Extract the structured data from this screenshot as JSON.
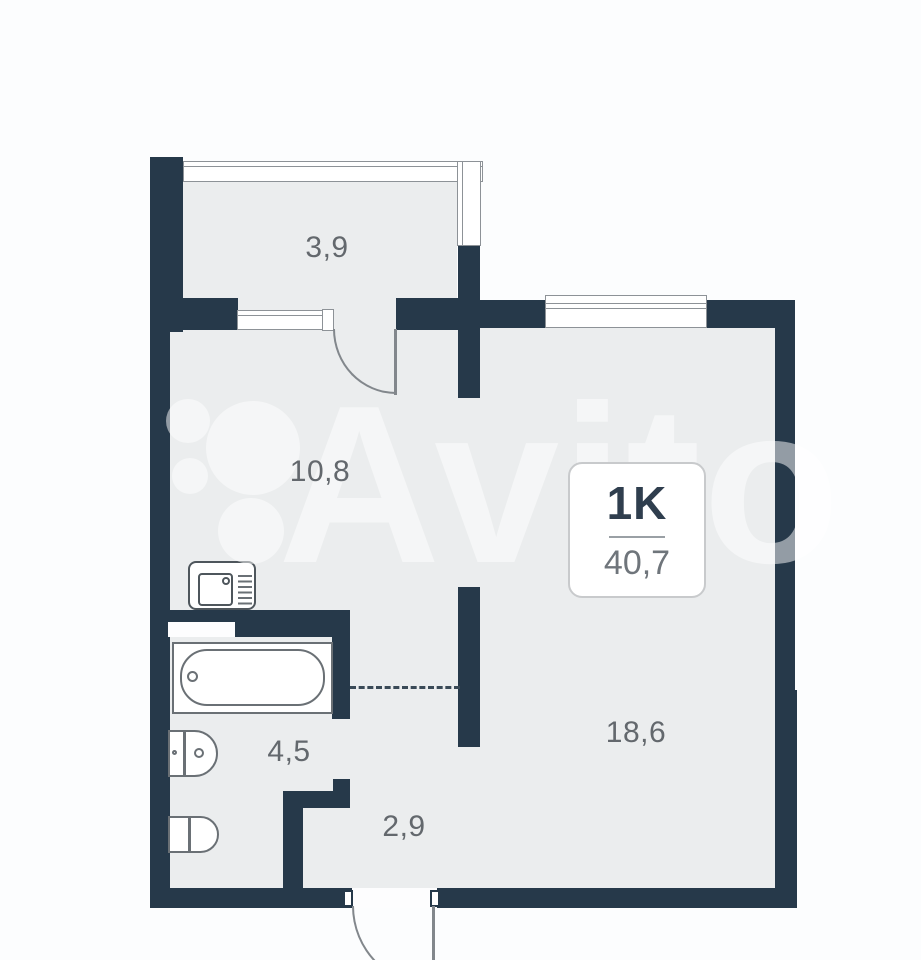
{
  "page": {
    "type": "apartment-floor-plan"
  },
  "watermark": {
    "brand": "Avito"
  },
  "plan": {
    "info_card": {
      "unit_type": "1K",
      "total_area": "40,7"
    },
    "rooms": [
      {
        "name": "balcony",
        "area_label": "3,9"
      },
      {
        "name": "kitchen-living",
        "area_label": "10,8"
      },
      {
        "name": "main-room",
        "area_label": "18,6"
      },
      {
        "name": "bathroom",
        "area_label": "4,5"
      },
      {
        "name": "hallway",
        "area_label": "2,9"
      }
    ],
    "fixtures": [
      "kitchen-sink",
      "bathtub",
      "toilet",
      "washbasin"
    ],
    "colors": {
      "wall": "#26394a",
      "floor": "#ebedee",
      "background": "#fcfdfe",
      "fixture_outline": "#6a7075",
      "window_line": "#8d9297",
      "door_line": "#82878c",
      "area_label_text": "#63686d",
      "unit_label_text": "#2f3e4e",
      "total_area_text": "#6f757b",
      "card_border": "#c8cacc"
    }
  }
}
